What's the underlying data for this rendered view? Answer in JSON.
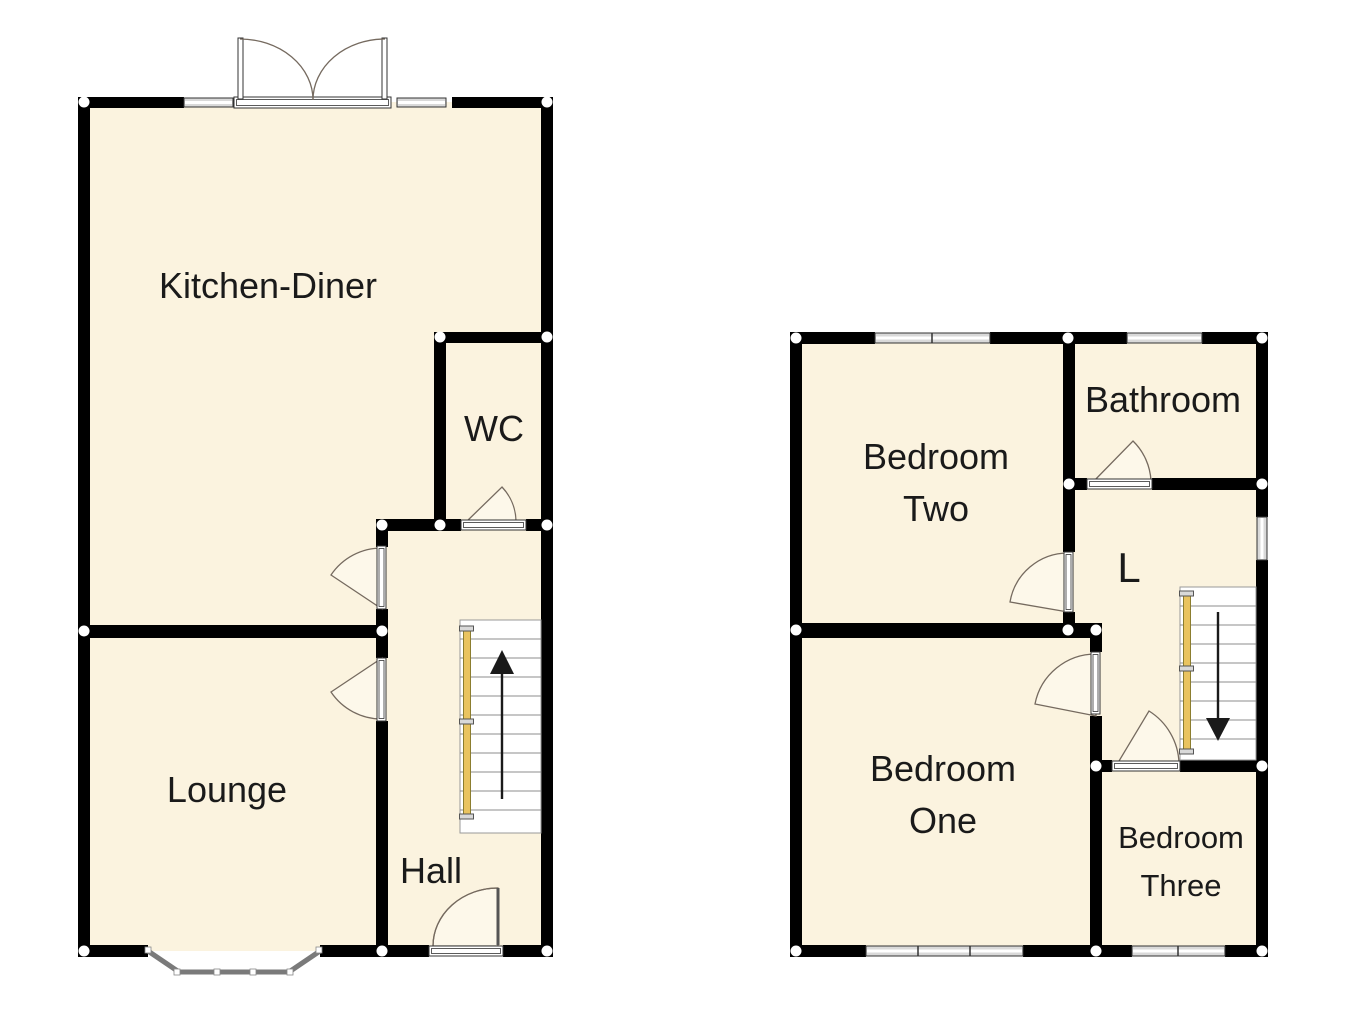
{
  "document": {
    "type": "floorplan",
    "floors": {
      "ground": {
        "rooms": {
          "kitchen_diner": "Kitchen-Diner",
          "wc": "WC",
          "lounge": "Lounge",
          "hall": "Hall"
        },
        "stair_direction": "up"
      },
      "first": {
        "rooms": {
          "bedroom_two_l1": "Bedroom",
          "bedroom_two_l2": "Two",
          "bathroom": "Bathroom",
          "landing": "L",
          "bedroom_one_l1": "Bedroom",
          "bedroom_one_l2": "One",
          "bedroom_three_l1": "Bedroom",
          "bedroom_three_l2": "Three"
        },
        "stair_direction": "down"
      }
    },
    "colors": {
      "wall": "#000000",
      "floor": "#fbf3df",
      "background": "#ffffff",
      "window_fill": "#d9d9d9",
      "door_swing": "#756a5f",
      "handrail": "#e9c360",
      "stair_tread": "#8c8c8c",
      "bay_window": "#7a7a7a",
      "text": "#1a1a1a"
    }
  }
}
